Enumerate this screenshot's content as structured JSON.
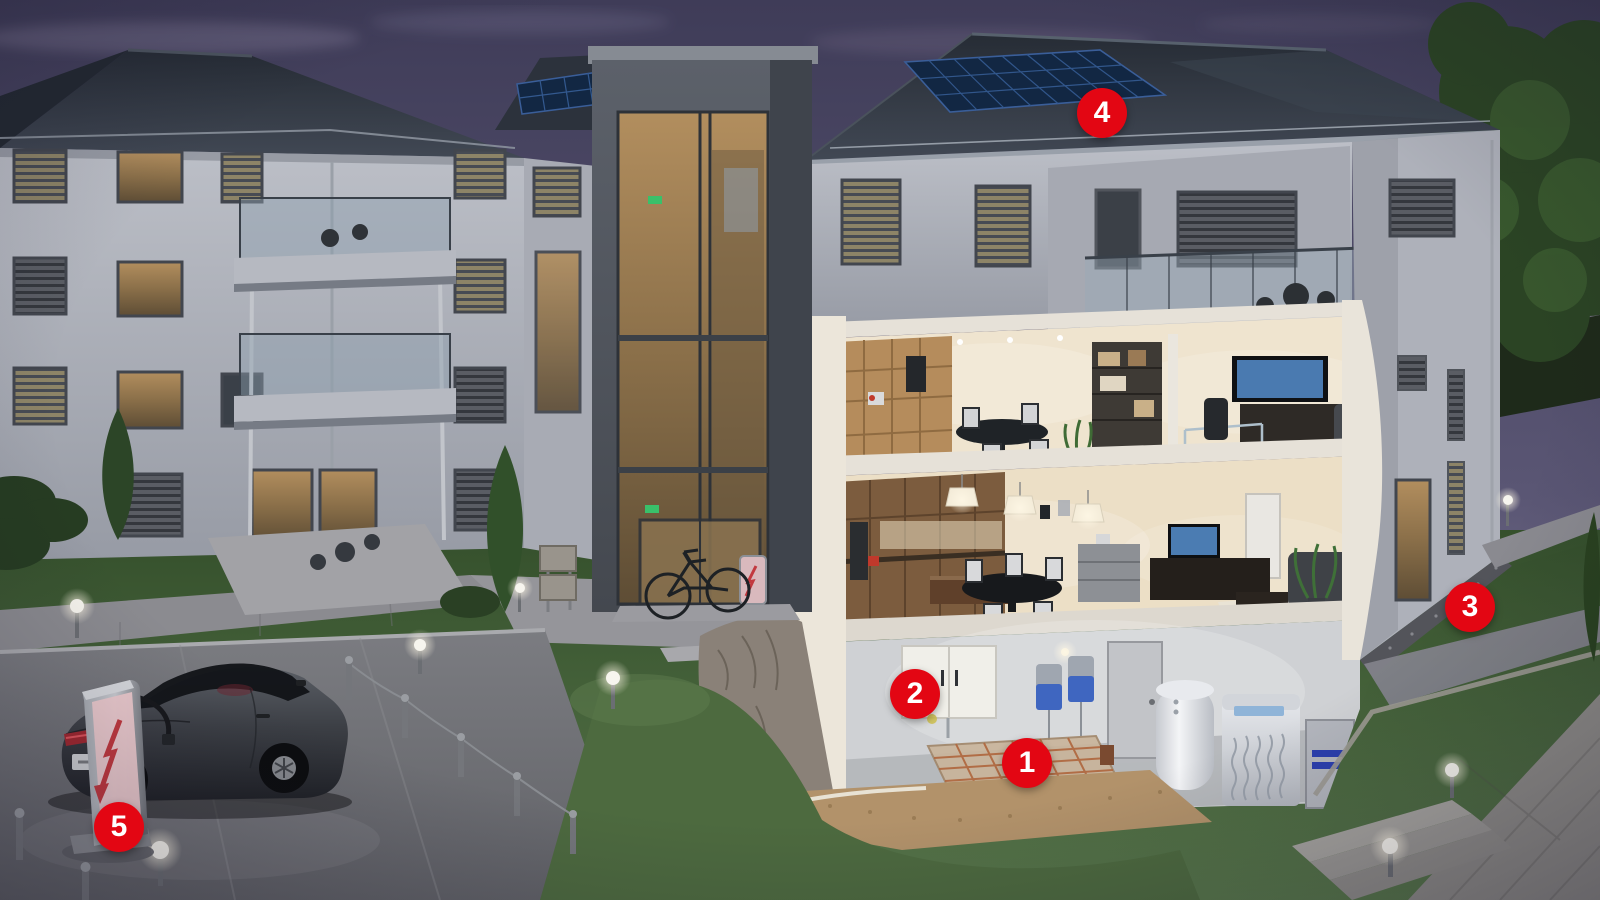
{
  "markers": [
    {
      "label": "1",
      "x": 1027,
      "y": 763
    },
    {
      "label": "2",
      "x": 915,
      "y": 694
    },
    {
      "label": "3",
      "x": 1470,
      "y": 607
    },
    {
      "label": "4",
      "x": 1102,
      "y": 113
    },
    {
      "label": "5",
      "x": 119,
      "y": 827
    }
  ],
  "colors": {
    "marker": "#e30613",
    "marker_text": "#ffffff",
    "sky_top": "#3f3c58",
    "sky_horizon": "#8b85a0",
    "roof": "#333944",
    "wall": "#b6b9c1",
    "solar_panel": "#122743",
    "solar_grid": "#33598f",
    "window_glow": "#c9a768",
    "grass_dark": "#35502c",
    "grass_light": "#57764a",
    "paving": "#86868c",
    "earth": "#b2926a",
    "charger_accent": "#c2393f",
    "car_body": "#3c3f45"
  },
  "icons": {
    "ev_charging_station": "lightning-bolt-down-arrow-icon",
    "ebike_charging_point": "lightning-bolt-icon",
    "path_lights": "globe-lamp-icon",
    "markers": "numbered-red-circle-icon"
  }
}
